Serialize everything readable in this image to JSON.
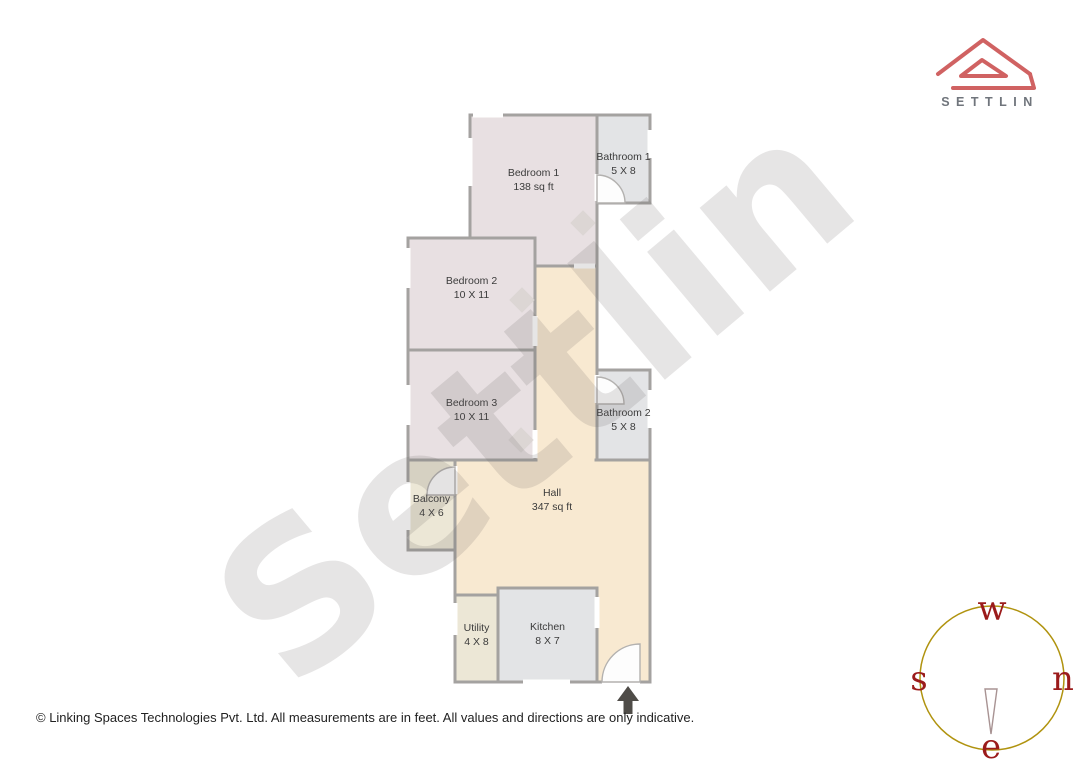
{
  "brand": {
    "logo_text": "SETTLIN"
  },
  "watermark": {
    "text": "Settlin"
  },
  "plan": {
    "rooms": {
      "bedroom1": {
        "name": "Bedroom 1",
        "size": "138 sq ft"
      },
      "bathroom1": {
        "name": "Bathroom 1",
        "size": "5 X 8"
      },
      "bedroom2": {
        "name": "Bedroom 2",
        "size": "10 X 11"
      },
      "bedroom3": {
        "name": "Bedroom 3",
        "size": "10 X 11"
      },
      "bathroom2": {
        "name": "Bathroom 2",
        "size": "5 X 8"
      },
      "balcony": {
        "name": "Balcony",
        "size": "4 X 6"
      },
      "hall": {
        "name": "Hall",
        "size": "347 sq ft"
      },
      "utility": {
        "name": "Utility",
        "size": "4 X 8"
      },
      "kitchen": {
        "name": "Kitchen",
        "size": "8 X 7"
      }
    }
  },
  "compass": {
    "top": "w",
    "right": "n",
    "left": "s",
    "bottom": "e"
  },
  "footer": {
    "disclaimer": "© Linking Spaces Technologies Pvt. Ltd. All measurements are in feet. All values and directions are only indicative."
  },
  "colors": {
    "bedroom_fill": "#e8e0e2",
    "bathroom_fill": "#e3e4e6",
    "hall_fill": "#f8e9d1",
    "balcony_fill": "#ece7d6",
    "wall": "#a4a2a0",
    "logo_accent": "#d06262",
    "logo_text": "#70757c",
    "compass_ring": "#b0930f",
    "compass_letters": "#9b1b1b",
    "north_arrow": "#4f4c48"
  }
}
